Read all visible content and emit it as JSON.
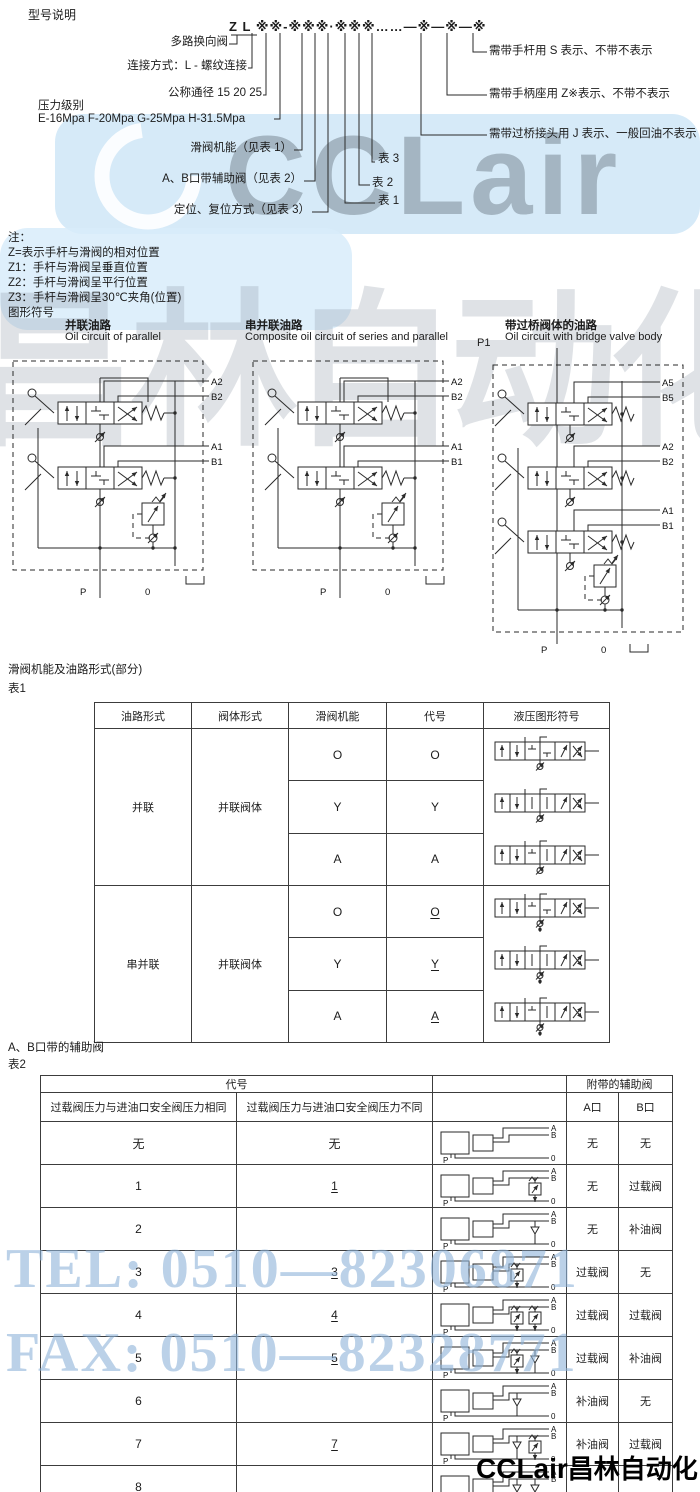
{
  "watermarks": {
    "brand": "CCLair",
    "brand_large_cn": "昌林自动化",
    "tel": "TEL: 0510—82306871",
    "fax": "FAX: 0510—82328771",
    "footer_brand": "CCLair",
    "footer_cn": "昌林自动化"
  },
  "model": {
    "title": "型号说明",
    "code": "Z L ※※-※※※·※※※……—※—※—※",
    "left_labels": [
      "多路换向阀",
      "连接方式：L - 螺纹连接",
      "公称通径 15 20 25",
      "滑阀机能（见表 1）",
      "A、B口带辅助阀（见表 2）",
      "定位、复位方式（见表 3）"
    ],
    "pressure_line1": "压力级别",
    "pressure_line2": "E-16Mpa F-20Mpa G-25Mpa H-31.5Mpa",
    "table_refs": [
      "表 1",
      "表 2",
      "表 3"
    ],
    "right_labels": [
      "需带手杆用 S 表示、不带不表示",
      "需带手柄座用 Z※表示、不带不表示",
      "需带过桥接头用 J 表示、一般回油不表示"
    ]
  },
  "notes": {
    "heading": "注：",
    "lines": [
      "Z=表示手杆与滑阀的相对位置",
      "Z1：手杆与滑阀呈垂直位置",
      "Z2：手杆与滑阀呈平行位置",
      "Z3：手杆与滑阀呈30℃夹角(位置)"
    ],
    "symbols_heading": "图形符号"
  },
  "circuits": [
    {
      "title_cn": "并联油路",
      "title_en": "Oil circuit of parallel",
      "sections": [
        {
          "a": "A2",
          "b": "B2"
        },
        {
          "a": "A1",
          "b": "B1"
        }
      ],
      "p": "P",
      "o": "0"
    },
    {
      "title_cn": "串并联油路",
      "title_en": "Composite oil circuit of series and parallel",
      "sections": [
        {
          "a": "A2",
          "b": "B2"
        },
        {
          "a": "A1",
          "b": "B1"
        }
      ],
      "p": "P",
      "o": "0"
    },
    {
      "title_cn": "带过桥阀体的油路",
      "title_en": "Oil circuit with bridge valve body",
      "p1": "P1",
      "sections": [
        {
          "a": "A5",
          "b": "B5"
        },
        {
          "a": "A2",
          "b": "B2"
        },
        {
          "a": "A1",
          "b": "B1"
        }
      ],
      "p": "P",
      "o": "0"
    }
  ],
  "table1": {
    "title": "滑阀机能及油路形式(部分)",
    "label": "表1",
    "headers": [
      "油路形式",
      "阀体形式",
      "滑阀机能",
      "代号",
      "液压图形符号"
    ],
    "groups": [
      {
        "circuit": "并联",
        "body": "并联阀体",
        "rows": [
          {
            "func": "O",
            "code": "O",
            "u": false
          },
          {
            "func": "Y",
            "code": "Y",
            "u": false
          },
          {
            "func": "A",
            "code": "A",
            "u": false
          }
        ]
      },
      {
        "circuit": "串并联",
        "body": "并联阀体",
        "rows": [
          {
            "func": "O",
            "code": "O",
            "u": true
          },
          {
            "func": "Y",
            "code": "Y",
            "u": true
          },
          {
            "func": "A",
            "code": "A",
            "u": true
          }
        ]
      }
    ]
  },
  "table2": {
    "title": "A、B口带的辅助阀",
    "label": "表2",
    "header_code": "代号",
    "header_aux": "附带的辅助阀",
    "col_same": "过载阀压力与进油口安全阀压力相同",
    "col_diff": "过载阀压力与进油口安全阀压力不同",
    "col_a": "A口",
    "col_b": "B口",
    "port_a": "A",
    "port_b": "B",
    "port_p": "P",
    "port_o": "0",
    "rows": [
      {
        "same": "无",
        "diff": "无",
        "u": false,
        "a": "无",
        "b": "无",
        "symA": "none",
        "symB": "none"
      },
      {
        "same": "1",
        "diff": "1",
        "u": true,
        "a": "无",
        "b": "过载阀",
        "symA": "none",
        "symB": "relief"
      },
      {
        "same": "2",
        "diff": "",
        "u": false,
        "a": "无",
        "b": "补油阀",
        "symA": "none",
        "symB": "check"
      },
      {
        "same": "3",
        "diff": "3",
        "u": true,
        "a": "过载阀",
        "b": "无",
        "symA": "relief",
        "symB": "none"
      },
      {
        "same": "4",
        "diff": "4",
        "u": true,
        "a": "过载阀",
        "b": "过载阀",
        "symA": "relief",
        "symB": "relief"
      },
      {
        "same": "5",
        "diff": "5",
        "u": true,
        "a": "过载阀",
        "b": "补油阀",
        "symA": "relief",
        "symB": "check"
      },
      {
        "same": "6",
        "diff": "",
        "u": false,
        "a": "补油阀",
        "b": "无",
        "symA": "check",
        "symB": "none"
      },
      {
        "same": "7",
        "diff": "7",
        "u": true,
        "a": "补油阀",
        "b": "过载阀",
        "symA": "check",
        "symB": "relief"
      },
      {
        "same": "8",
        "diff": "",
        "u": false,
        "a": "",
        "b": "",
        "symA": "check",
        "symB": "check"
      }
    ]
  }
}
